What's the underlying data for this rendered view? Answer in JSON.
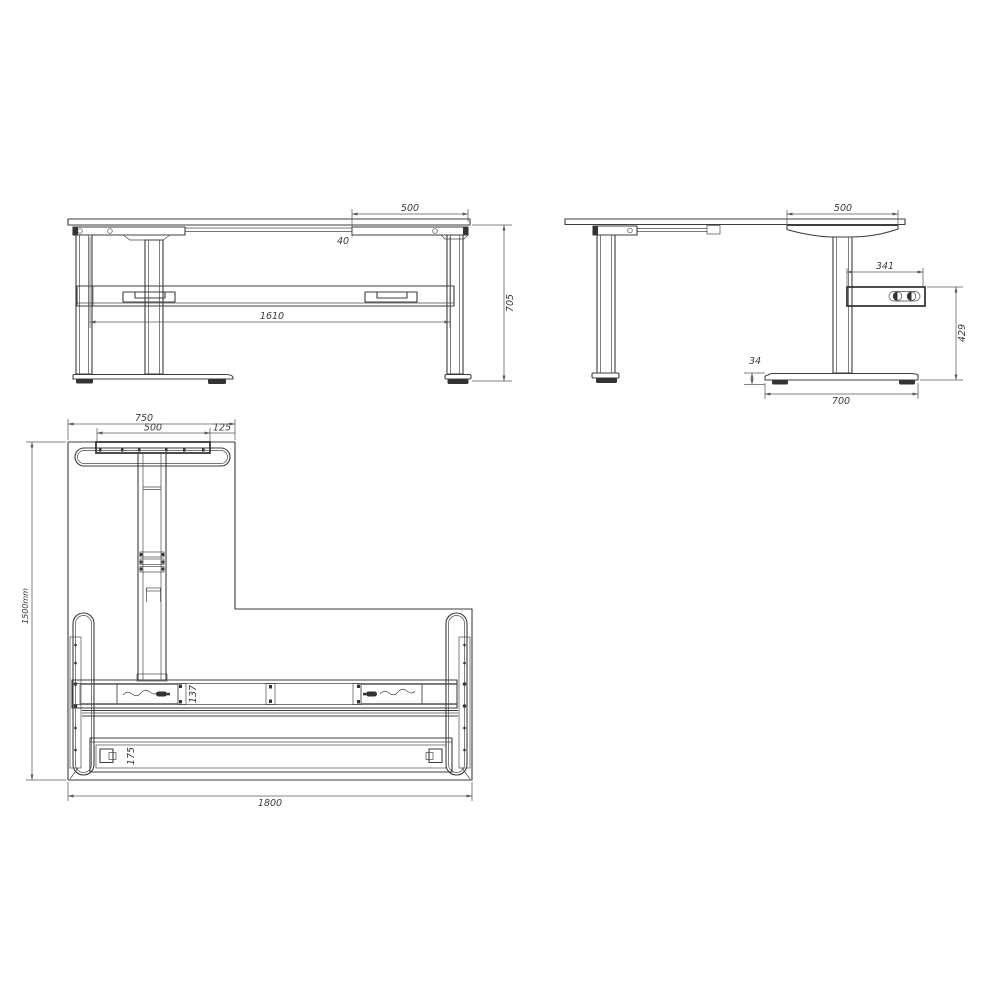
{
  "views": {
    "front": {
      "dim_overhang": "500",
      "dim_gap": "40",
      "dim_beam": "1610",
      "dim_height": "705"
    },
    "side": {
      "dim_overhang": "500",
      "dim_box_width": "341",
      "dim_box_height": "429",
      "dim_foot_height": "34",
      "dim_foot_length": "700"
    },
    "plan": {
      "dim_foot_span": "750",
      "dim_plate": "500",
      "dim_offset": "125",
      "dim_depth": "1500mm",
      "dim_width": "1800",
      "dim_beam_depth": "137",
      "dim_rail_depth": "175"
    }
  }
}
